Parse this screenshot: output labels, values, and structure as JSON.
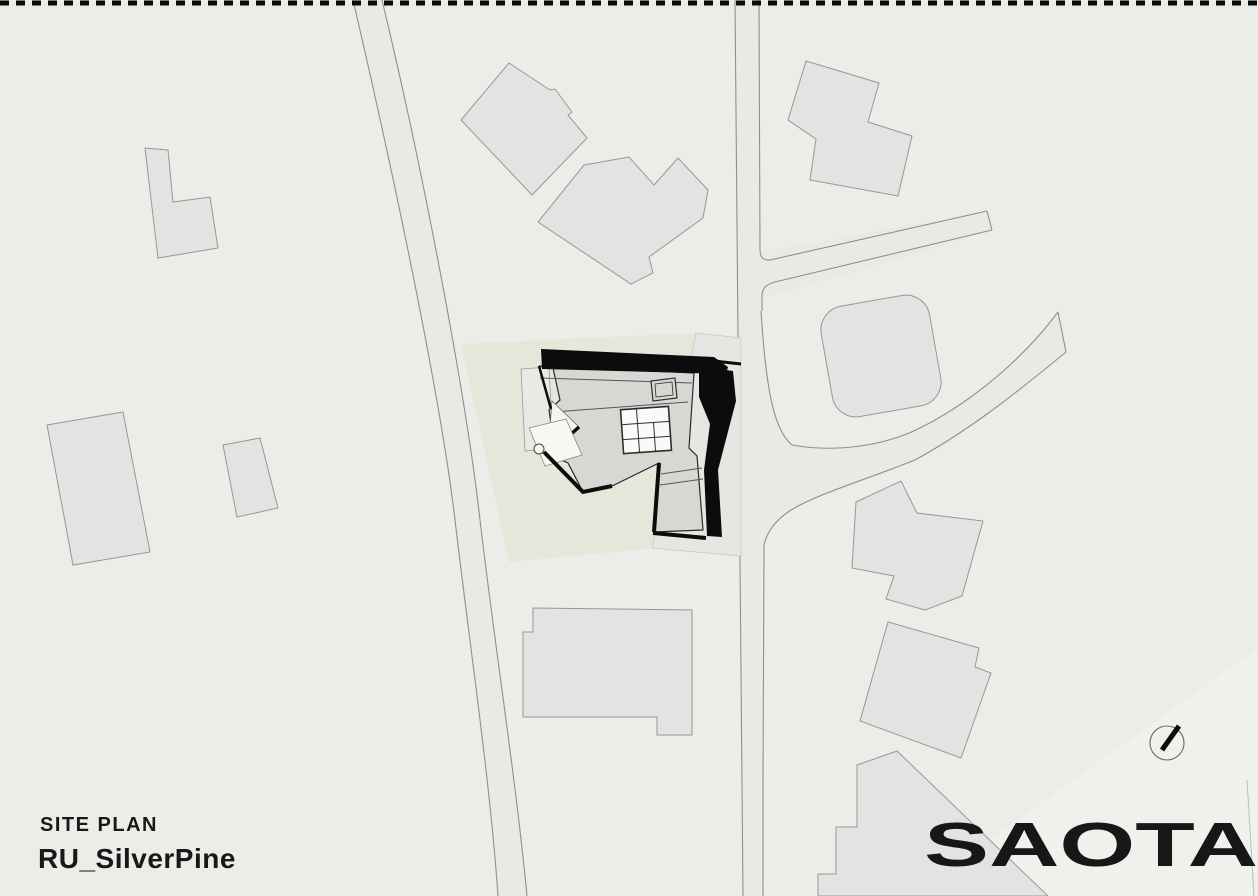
{
  "document": {
    "kind": "architectural site plan drawing",
    "orientation": "landscape"
  },
  "title_block": {
    "drawing_type": "SITE PLAN",
    "project_name": "RU_SilverPine"
  },
  "logo": {
    "text": "SAOTA"
  },
  "north_indicator": {
    "name": "north-arrow-compass",
    "style": "circle with thick needle pointing upper-right"
  },
  "colors": {
    "background": "#ECEDE8",
    "neighbor_building_fill": "#E3E4E1",
    "building_outline": "#97979B",
    "road_fill": "#EAE9E6",
    "road_edge": "#8F8F8C",
    "site_landscape_green": "#E3E8DA",
    "site_paving": "#E7E6E3",
    "main_roof_gray": "#D7D8D4",
    "shadow_black": "#0C0C0C",
    "text_black": "#181818"
  },
  "features": {
    "boundary": "dashed property/drawing boundary line along top edge",
    "roads": [
      "west diagonal road",
      "main vertical road",
      "upper driveway lane (north-east)",
      "curved cul-de-sac driveway (east)",
      "south-east road band"
    ],
    "site": "main site parcel with landscaped green area and paved east strip",
    "main_building": "dark rendered roof plan of RU_SilverPine house with skylight grid, roof terrace, pool deck circle and cast shadows",
    "neighbor_buildings": [
      "l-shaped house north-west",
      "rotated house north a",
      "rotated house north b",
      "stepped house north-east",
      "rounded-square house east",
      "large house west",
      "small house west",
      "large house south of site",
      "stepped house east-middle",
      "square house east-lower",
      "terraced house south-east (runs off page)"
    ]
  }
}
